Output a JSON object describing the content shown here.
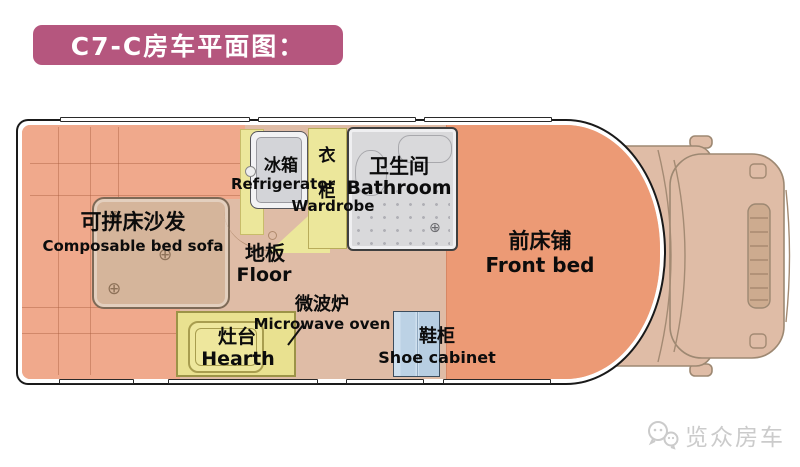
{
  "title": {
    "text": "C7-C房车平面图："
  },
  "floorplan": {
    "sofa": {
      "zh": "可拼床沙发",
      "en": "Composable bed sofa"
    },
    "refrigerator": {
      "zh": "冰箱",
      "en": "Refrigerator"
    },
    "wardrobe": {
      "zh_char1": "衣",
      "zh_char2": "柜",
      "en": "Wardrobe"
    },
    "bathroom": {
      "zh": "卫生间",
      "en": "Bathroom"
    },
    "floor": {
      "zh": "地板",
      "en": "Floor"
    },
    "front_bed": {
      "zh": "前床铺",
      "en": "Front bed"
    },
    "microwave": {
      "zh": "微波炉",
      "en": "Microwave oven"
    },
    "hearth": {
      "zh": "灶台",
      "en": "Hearth"
    },
    "shoe_cabinet": {
      "zh": "鞋柜",
      "en": "Shoe cabinet"
    }
  },
  "icons": {
    "cup_holder": "⊕",
    "bolt": "⊕"
  },
  "watermark": {
    "brand": "览众房车"
  },
  "colors": {
    "banner": "#b5567e",
    "sofa": "#f0a98c",
    "floor": "#dfbca6",
    "front_bed": "#ec9a75",
    "hearth": "#e9e190",
    "wardrobe": "#ece79b",
    "bathroom": "#d9d9db",
    "shoe_cabinet": "#c2d5e7",
    "cab": "#dfbca6",
    "outline": "#1a1a1a",
    "watermark_text": "#cbcbcb"
  }
}
